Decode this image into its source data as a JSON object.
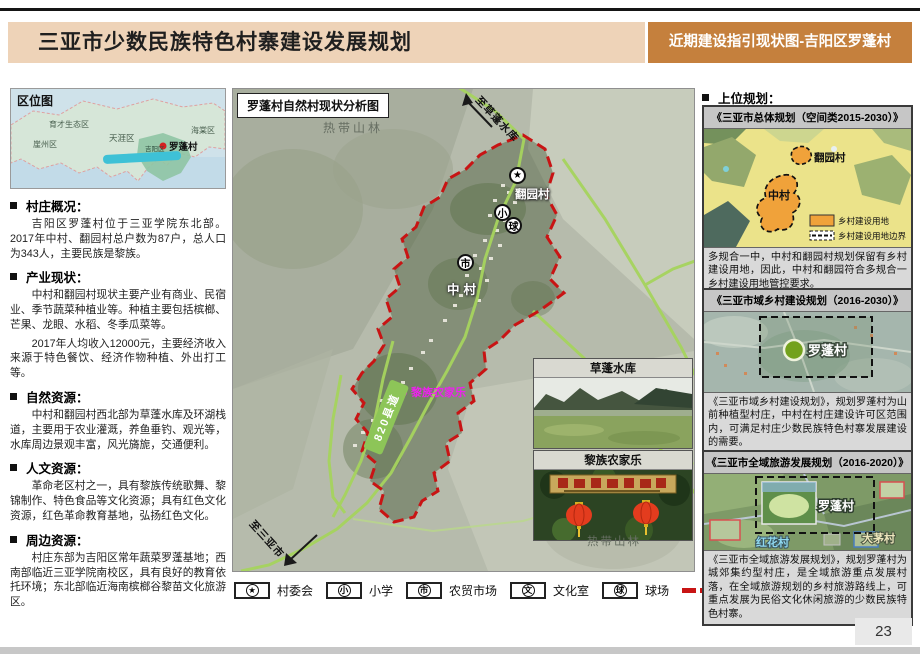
{
  "header": {
    "title": "三亚市少数民族特色村寨建设发展规划",
    "subtitle": "近期建设指引现状图-吉阳区罗蓬村"
  },
  "page": {
    "number": "23"
  },
  "colors": {
    "header_tan": "#eed3b8",
    "header_orange": "#c5803d",
    "boundary_red": "#c81414",
    "road_green": "#8dc558",
    "highlight_magenta": "#ee20ee",
    "plan_orange": "#f0a23a"
  },
  "left": {
    "location_map": {
      "label": "区位图",
      "regions": [
        "育才生态区",
        "崖州区",
        "天涯区",
        "海棠区",
        "吉阳区"
      ],
      "marker": "罗蓬村"
    },
    "sections": [
      {
        "heading": "村庄概况：",
        "paragraphs": [
          "吉阳区罗蓬村位于三亚学院东北部。2017年中村、翻园村总户数为87户，总人口为343人，主要民族是黎族。"
        ]
      },
      {
        "heading": "产业现状：",
        "paragraphs": [
          "中村和翻园村现状主要产业有商业、民宿业、季节蔬菜种植业等。种植主要包括槟榔、芒果、龙眼、水稻、冬季瓜菜等。",
          "2017年人均收入12000元，主要经济收入来源于特色餐饮、经济作物种植、外出打工等。"
        ]
      },
      {
        "heading": "自然资源：",
        "paragraphs": [
          "中村和翻园村西北部为草蓬水库及环湖栈道，主要用于农业灌溉，养鱼垂钓、观光等，水库周边景观丰富，风光旖旎，交通便利。"
        ]
      },
      {
        "heading": "人文资源：",
        "paragraphs": [
          "革命老区村之一，具有黎族传统歌舞、黎锦制作、特色食品等文化资源；具有红色文化资源，红色革命教育基地，弘扬红色文化。"
        ]
      },
      {
        "heading": "周边资源：",
        "paragraphs": [
          "村庄东部为吉阳区常年蔬菜罗蓬基地；西南部临近三亚学院南校区，具有良好的教育依托环境；东北部临近海南槟榔谷黎苗文化旅游区。"
        ]
      }
    ]
  },
  "map": {
    "title": "罗蓬村自然村现状分析图",
    "labels": {
      "forest_top": "热带山林",
      "forest_bottom": "热带山林",
      "to_reservoir": "至草蓬水库",
      "to_city": "至三亚市",
      "road": "820县道",
      "agritainment": "黎族农家乐",
      "village_fanyuan": "翻园村",
      "village_zhong": "中村"
    },
    "markers": {
      "committee": "★",
      "school": "小",
      "market": "市",
      "court": "球"
    },
    "insets": [
      {
        "title": "草蓬水库"
      },
      {
        "title": "黎族农家乐"
      }
    ],
    "legend": [
      {
        "icon": "★",
        "label": "村委会"
      },
      {
        "icon": "小",
        "label": "小学"
      },
      {
        "icon": "市",
        "label": "农贸市场"
      },
      {
        "icon": "文",
        "label": "文化室"
      },
      {
        "icon": "球",
        "label": "球场"
      },
      {
        "icon": "red-dash",
        "label": "自然村范围"
      }
    ]
  },
  "right": {
    "heading": "上位规划：",
    "boxes": [
      {
        "title": "《三亚市总体规划（空间类2015-2030）》",
        "map_labels": [
          "翻园村",
          "中村"
        ],
        "legend": [
          "乡村建设用地",
          "乡村建设用地边界"
        ],
        "caption": "多规合一中，中村和翻园村规划保留有乡村建设用地，因此，中村和翻园符合多规合一乡村建设用地管控要求。"
      },
      {
        "title": "《三亚市域乡村建设规划（2016-2030）》",
        "map_labels": [
          "罗蓬村"
        ],
        "legend": [],
        "caption": "《三亚市域乡村建设规划》，规划罗蓬村为山前种植型村庄，中村在村庄建设许可区范围内，可满足村庄少数民族特色村寨发展建设的需要。"
      },
      {
        "title": "《三亚市全域旅游发展规划（2016-2020）》",
        "map_labels": [
          "罗蓬村",
          "红花村",
          "大茅村"
        ],
        "legend": [],
        "caption": "《三亚市全域旅游发展规划》，规划罗蓬村为城郊集约型村庄，是全域旅游重点发展村落，在全域旅游规划的乡村旅游路线上，可重点发展为民俗文化休闲旅游的少数民族特色村寨。"
      }
    ]
  }
}
